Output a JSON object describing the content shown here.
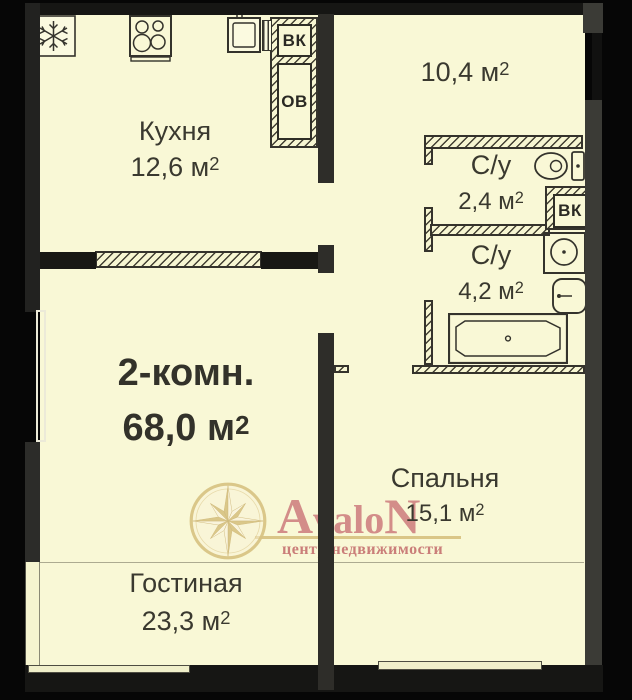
{
  "apartment": {
    "type_label": "2-комн.",
    "area": "68,0"
  },
  "units": {
    "symbol": "м",
    "sup": "2"
  },
  "rooms": {
    "kitchen": {
      "name": "Кухня",
      "area": "12,6"
    },
    "hallway": {
      "area": "10,4"
    },
    "wc_small": {
      "name": "С/у",
      "area": "2,4"
    },
    "wc_large": {
      "name": "С/у",
      "area": "4,2"
    },
    "bedroom": {
      "name": "Спальня",
      "area": "15,1"
    },
    "living": {
      "name": "Гостиная",
      "area": "23,3"
    }
  },
  "shafts": {
    "vk_kitchen": "ВК",
    "ov_kitchen": "ОВ",
    "vk_bath": "ВК"
  },
  "watermark": {
    "brand_first": "A",
    "brand_mid": "valo",
    "brand_last": "N",
    "tagline": "центр недвижимости"
  },
  "colors": {
    "room_fill": "#f9f8d6",
    "wall_grey": "#3b3b36",
    "wall_dark": "#161614",
    "logo_gold": "#d8c383",
    "logo_pink": "#cd7d7e"
  }
}
